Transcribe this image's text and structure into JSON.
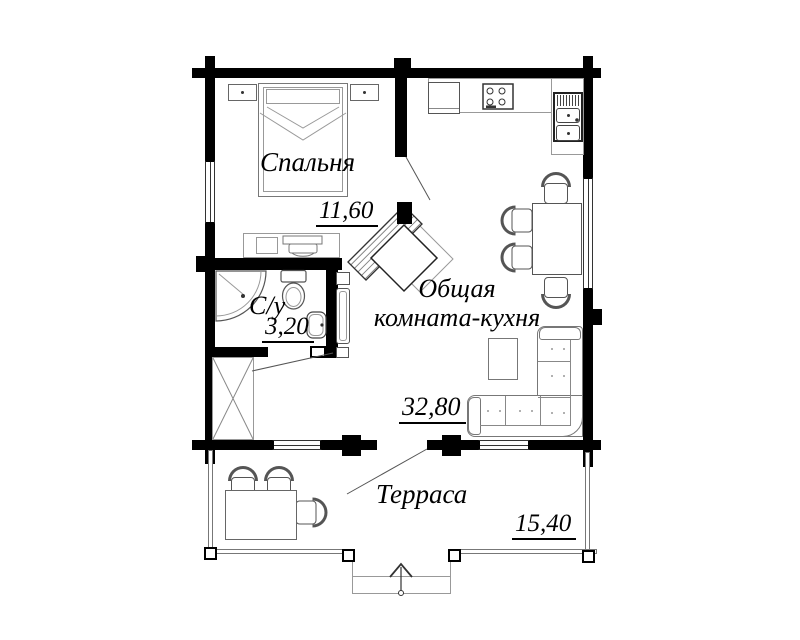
{
  "plan": {
    "type": "floor-plan",
    "rooms": [
      {
        "id": "bedroom",
        "name": "Спальня",
        "area": "11,60"
      },
      {
        "id": "bathroom",
        "name": "С/у",
        "area": "3,20"
      },
      {
        "id": "living-kitchen",
        "name": "Общая комната-кухня",
        "name_line1": "Общая",
        "name_line2": "комната-кухня",
        "area": "32,80"
      },
      {
        "id": "terrace",
        "name": "Терраса",
        "area": "15,40"
      }
    ],
    "furniture_symbols": [
      "double-bed",
      "nightstand",
      "dresser-with-tv",
      "corner-fireplace",
      "wardrobe",
      "kitchen-cabinet",
      "stove",
      "kitchen-sink",
      "dining-table",
      "chair",
      "corner-sofa",
      "coffee-table",
      "corner-shower",
      "toilet",
      "washbasin",
      "boiler-cabinet",
      "terrace-table",
      "entrance-steps",
      "up-arrow"
    ],
    "colors": {
      "wall": "#000000",
      "furniture": "#777777",
      "text": "#000000",
      "background": "#ffffff"
    }
  }
}
